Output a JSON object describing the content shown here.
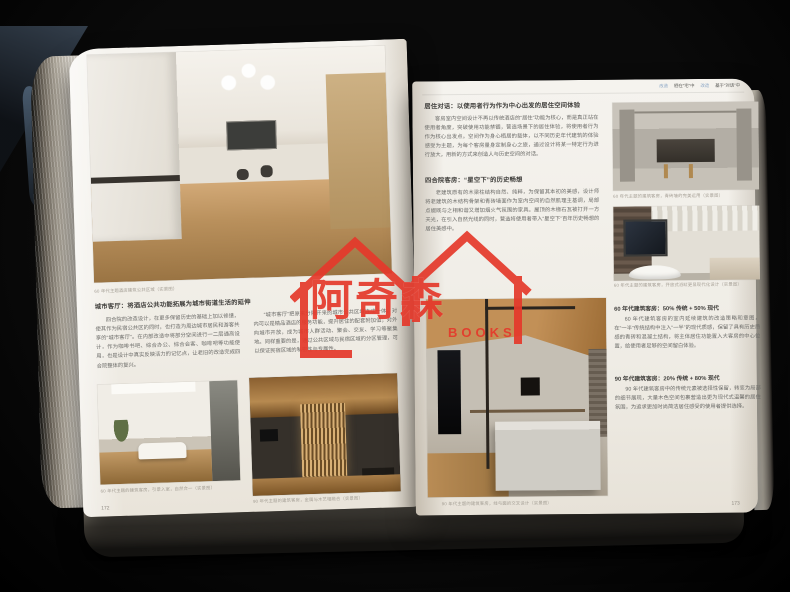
{
  "scene": {
    "watermark_name": "阿奇森",
    "watermark_sub": "BOOKS",
    "watermark_color": "#e5392b"
  },
  "running_header": {
    "seg1": "改造",
    "seg2": "栖在“宅”中",
    "seg3": "改造",
    "seg4": "基于“对话”中"
  },
  "left": {
    "page_number": "172",
    "hero_caption": "60 年代主题酒店建筑公共区域（实景图）",
    "section_heading": "城市客厅：将酒店公共功能拓展为城市街道生活的延伸",
    "col1": "四合院的改造设计，在更多保留历史的基础上加以修缮，使其作为民宿公共区的同时，也打造为周边城市居民和游客共享的“城市客厅”。在内部改造中将部分空间进行一二层通高设计，作为咖啡书吧、综合办公、综合会客、咖啡吧等功能使用，也是设计中真实反映活力的记忆点，让老旧的改造完成四合院整体的复兴。",
    "col2": "“城市客厅”把原来分隔开来的城市公共区域连成一体，对内可以是精品酒店的服务功能，提升居住的配套附加值；对外向城市开放，成为城市人群活动、聚会、交友、学习等聚集地。同样重要的是，通过公共区域与民宿区域的分区管理，可以保证民宿区域的私密性与专属性。",
    "photo_a_caption": "60 年代主题的建筑客房，引景入室，自然合一（实景图）",
    "photo_b_caption": "90 年代主题的建筑客房，金属与木艺相融合（实景图）"
  },
  "right": {
    "page_number": "173",
    "heading1": "居住对话：以使用者行为作为中心出发的居住空间体验",
    "para1": "客房室内空间设计不再以传统酒店的“居住”功能为核心，而是真正站在使用者角度，突破使用功能禁锢，营造场景下的居住体验，将使用者行为作为核心出发点。空间作为身心栖居的载体，以不同历史年代建筑的体验感受为主题，为每个客房量身定制身心之旅，通过设计将某一特定行为进行放大，用新的方式来创造人与历史空间的对话。",
    "heading2": "四合院客房：“星空下”的历史畅想",
    "para2": "老建筑原有的木梁柱结构自然、纯粹，为保留其本初的美感，设计师将老建筑的木结构骨架和青砖墙面作为室内空间的自然肌理主基调，局部点缀既与之相和谐又增加烟火气氛围的家具。屋顶的木椽石瓦被打开一方天光，在引入自然光线的同时，营造将使用者带入“星空下”百年历史畅想的居住美感中。",
    "photo1_caption": "60 年代主题的建筑客房，青砖墙的完美运用（实景图）",
    "photo2_caption": "60 年代主题的建筑客房，开放式浴缸更显现代化设计（实景图）",
    "heading3": "60 年代建筑客房：50% 传统 + 50% 现代",
    "para3": "60 年代建筑客房的室内延续建筑的改造策略和意图，在“一半”传统结构中注入“一半”的现代质感，保留了具有历史质感的青砖和混凝土结构，将主体居住功能置入大客房的中心位置，给使用者足够的空间留白体验。",
    "heading4": "90 年代建筑客房：20% 传统 + 80% 现代",
    "para4": "90 年代建筑客房中的传统元素被选择性保留，转变为局部的细节展现，大量木色空间包裹营造出更为现代式温馨的居住氛围，为追求更加时尚简洁居住感受的使用者提供选择。",
    "hero_caption": "90 年代主题的建筑客房，线与面的交叉设计（实景图）"
  }
}
